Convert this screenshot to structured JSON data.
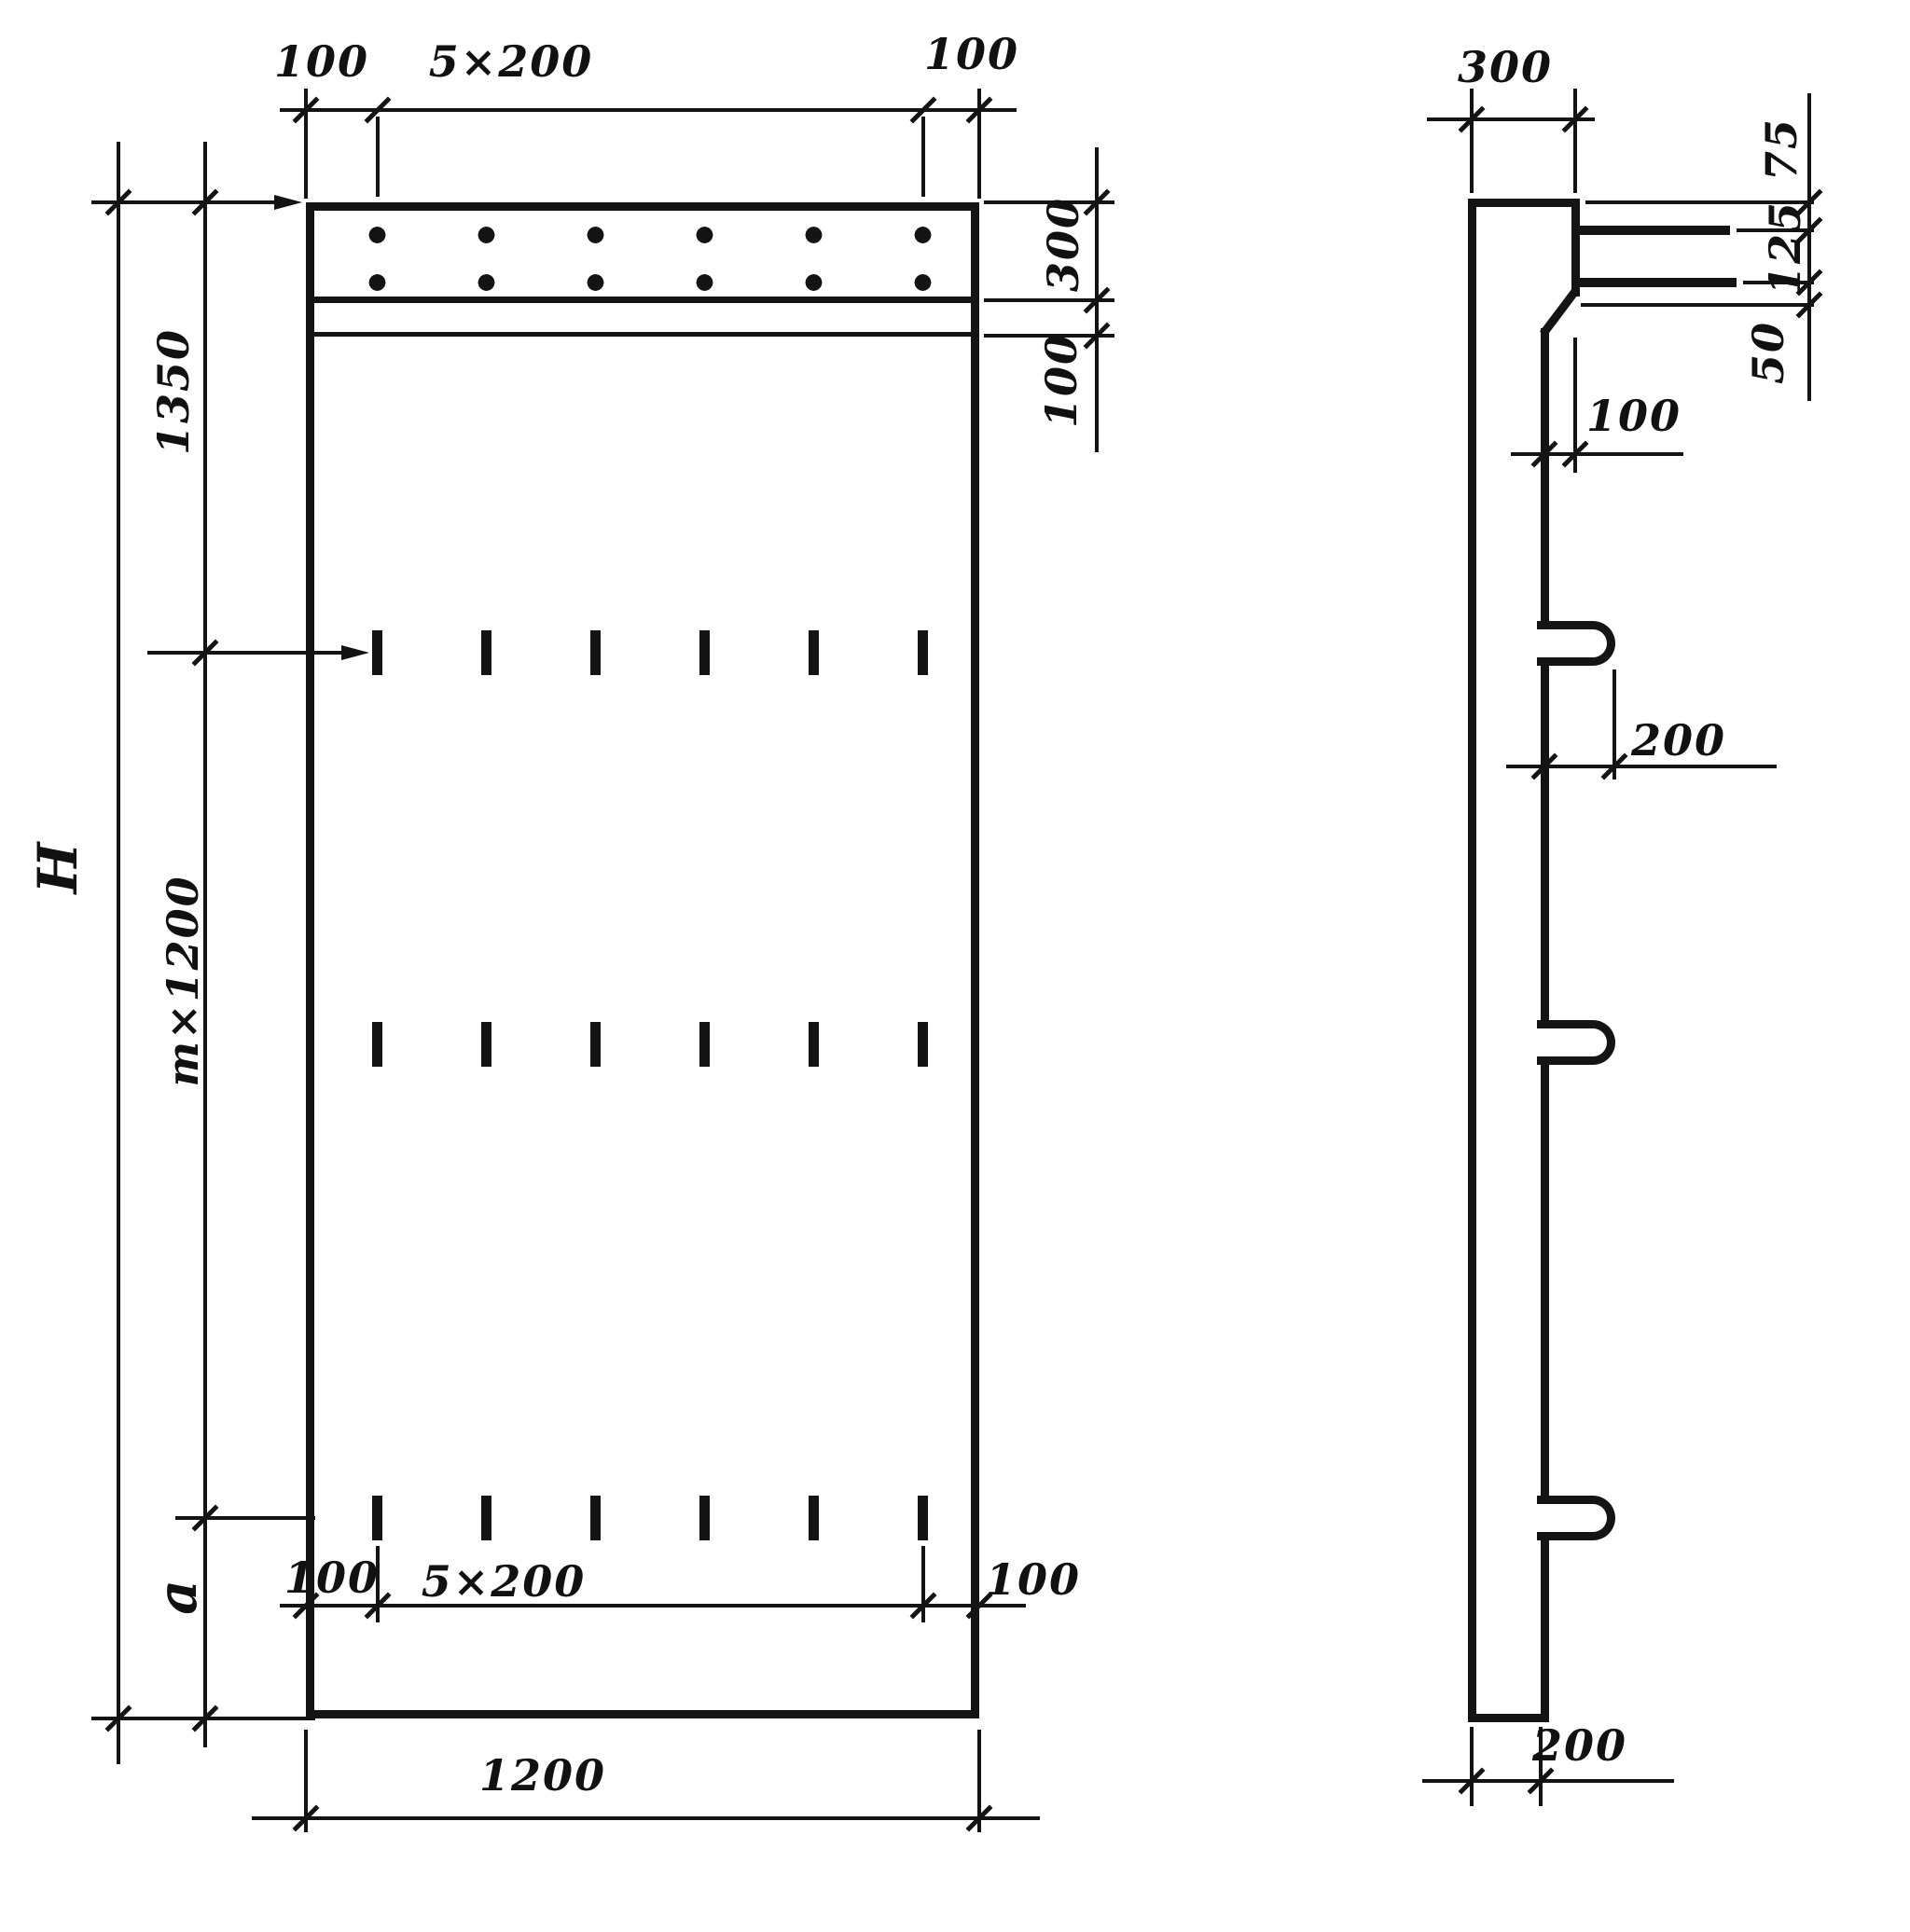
{
  "page": {
    "background": "#ffffff",
    "ink": "#141414"
  },
  "drawing": {
    "kind": "engineering drawing — concrete panel, elevation and side section",
    "front_view": {
      "top_chain": {
        "left": "100",
        "middle": "5×200",
        "right": "100"
      },
      "right_chain": {
        "top": "300",
        "bottom": "100"
      },
      "left_chain": {
        "overall": "H",
        "top": "1350",
        "middle": "m×1200",
        "bottom": "a"
      },
      "bottom_chain": {
        "left": "100",
        "middle": "5×200",
        "right": "100"
      },
      "width": "1200"
    },
    "side_view": {
      "top_width": "300",
      "right_chain": {
        "top": "75",
        "middle": "125",
        "bottom": "50"
      },
      "step": "100",
      "loop_length": "200",
      "thickness": "200"
    }
  }
}
